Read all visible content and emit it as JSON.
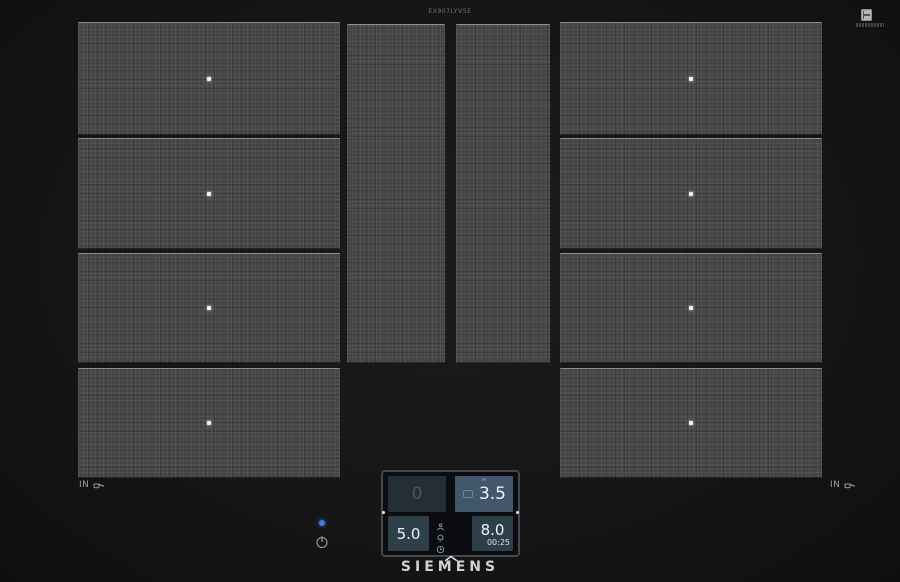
{
  "fine_print": {
    "model_text": "EX907LYV5E"
  },
  "hob": {
    "in_left_label": "IN",
    "in_right_label": "IN",
    "zones": [
      {
        "id": "left-1",
        "dot": true
      },
      {
        "id": "left-2",
        "dot": true
      },
      {
        "id": "left-3",
        "dot": true
      },
      {
        "id": "left-4",
        "dot": true
      },
      {
        "id": "middle-1",
        "dot": false
      },
      {
        "id": "middle-2",
        "dot": false
      },
      {
        "id": "right-1",
        "dot": true
      },
      {
        "id": "right-2",
        "dot": true
      },
      {
        "id": "right-3",
        "dot": true
      },
      {
        "id": "right-4",
        "dot": true
      }
    ]
  },
  "display": {
    "top_left": {
      "value": "0"
    },
    "top_right": {
      "value": "3.5"
    },
    "bottom_left": {
      "value": "5.0"
    },
    "bottom_right": {
      "value": "8.0",
      "timer": "00:25"
    }
  },
  "icons": {
    "middle_stack": [
      "assist-icon",
      "bell-icon",
      "clock-icon"
    ],
    "chevron": "chevron-up-icon",
    "power": "power-icon",
    "pan": "pan-icon"
  },
  "colors": {
    "led_blue": "#3f7dd8",
    "tile_active": "#42586a",
    "tile_mid": "#2f3f4a",
    "tile_inactive": "#232e37",
    "zone_gray": "#454545"
  },
  "branding": {
    "logo": "SIEMENS"
  }
}
